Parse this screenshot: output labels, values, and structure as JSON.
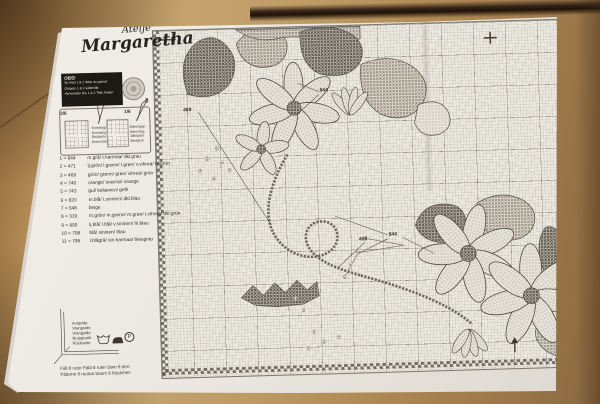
{
  "brand": {
    "name_line1": "Ateljé",
    "name_line2": "Margaretha"
  },
  "notice": {
    "title": "OBS!",
    "line1": "Sy med 1 & 2 delar av garnet",
    "line2": "Ompele 1 & 2 säikeellä",
    "line3": "Verwenden Sie 1 & 2 Teile Faden"
  },
  "stitch_key": {
    "cross": {
      "ratio": "2/6",
      "name_sv": "Korsstygn",
      "name_no": "Korssting",
      "name_fi": "Ristipisto",
      "name_de": "Kreuzstich"
    },
    "back": {
      "ratio": "1/6",
      "name_sv": "Efterstygn",
      "name_no": "Attersting",
      "name_fi": "Jälkipisto",
      "name_de": "Stielstich"
    }
  },
  "threads": {
    "rows": [
      {
        "label": "1 = 844",
        "names": "m.grå/ t.harmaa/ dkl.grau"
      },
      {
        "label": "2 = 471",
        "names": "lj.grön/ l.grønn/ l.grøn/ v.vihreä/ hl.grün"
      },
      {
        "label": "3 = 469",
        "names": "grön/ grønn/ grøn/ vihreä/ grün"
      },
      {
        "label": "4 = 740",
        "names": "orange/ oranssi/ orange"
      },
      {
        "label": "5 = 743",
        "names": "gul/ keltainen/ gelb"
      },
      {
        "label": "6 = 820",
        "names": "m.blå/ t.sininen/ dkl.blau"
      },
      {
        "label": "7 = 648",
        "names": "beige"
      },
      {
        "label": "8 = 319",
        "names": "m.grön/ m.grønn/ m.grøn/ t.vihreä/ dkl.grün"
      },
      {
        "label": "9 = 800",
        "names": "lj.blå/ l.blå/ v.sininen/ hl.blau"
      },
      {
        "label": "10 = 798",
        "names": "blå/ sininen/ blau"
      },
      {
        "label": "11 = 799",
        "names": "l.blågrå/ sin.harmaa/ blaugrau"
      }
    ]
  },
  "hem": {
    "line1": "Avigsida",
    "line2": "Vrangside",
    "line3": "Vrangside",
    "line4": "Nurjapuoli",
    "line5": "Rückseite"
  },
  "care": {
    "p_symbol": "P",
    "icons": [
      "washtub-icon",
      "iron-icon",
      "circle-p-icon"
    ]
  },
  "fold": {
    "line1": "Fäll 8 rutor  Fäld 8 ruter  Søm 8 tern",
    "line2": "Päärme 8 ruutua  Saum  8 Kästchen"
  },
  "chart_labels": {
    "top_left": "469",
    "top_right": "844",
    "bottom_left": "469",
    "bottom_right": "844"
  },
  "icons": {
    "start_arrow": "right-arrow",
    "center_mark": "plus-cross",
    "bottom_mark": "up-arrow"
  },
  "colors": {
    "paper": "#ece9e2",
    "wood": "#b28a58",
    "wood_gap": "#1f1206",
    "ink": "#3a362f",
    "grid_line": "#8d887c",
    "notice_bg": "#1d1a16"
  }
}
